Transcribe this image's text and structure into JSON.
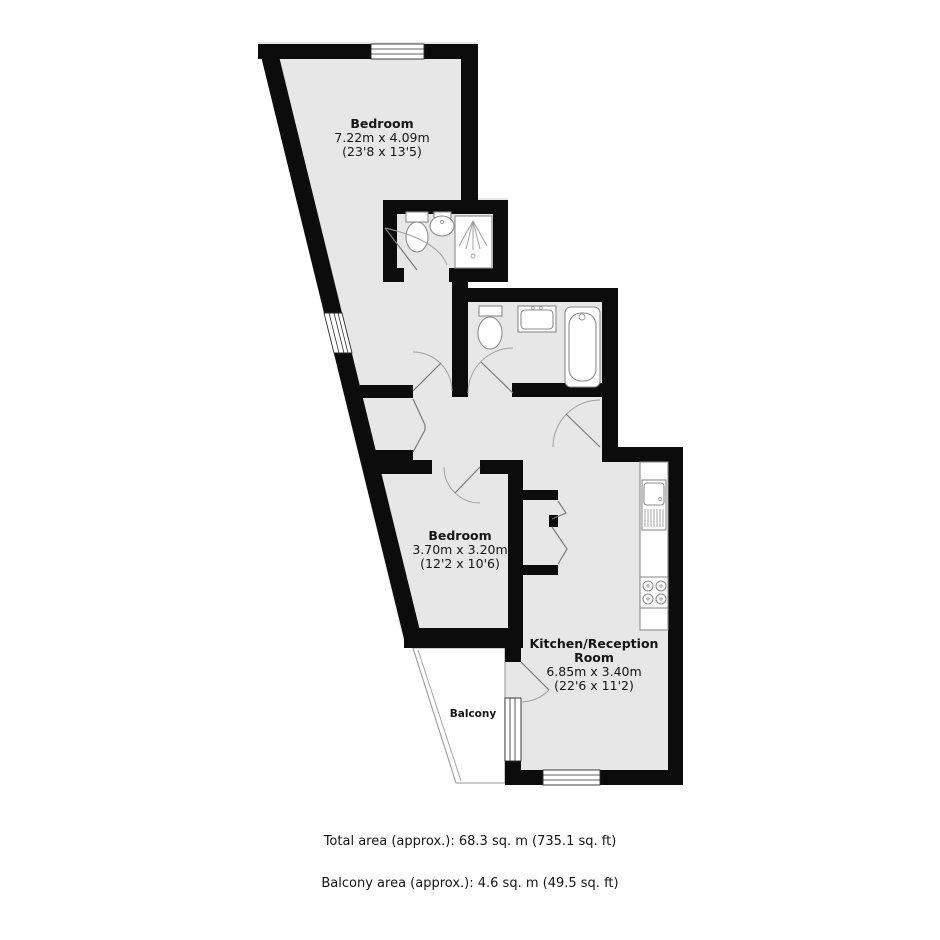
{
  "plan": {
    "rooms": {
      "bedroom1": {
        "name": "Bedroom",
        "dims_metric": "7.22m x 4.09m",
        "dims_imperial": "(23'8 x 13'5)"
      },
      "bedroom2": {
        "name": "Bedroom",
        "dims_metric": "3.70m x 3.20m",
        "dims_imperial": "(12'2 x 10'6)"
      },
      "kitchen_reception": {
        "name_line1": "Kitchen/Reception",
        "name_line2": "Room",
        "dims_metric": "6.85m x 3.40m",
        "dims_imperial": "(22'6 x 11'2)"
      },
      "balcony": {
        "name": "Balcony"
      }
    },
    "footer": {
      "total_area": "Total area (approx.): 68.3 sq. m (735.1 sq. ft)",
      "balcony_area": "Balcony area (approx.): 4.6 sq. m (49.5 sq. ft)"
    },
    "colors": {
      "wall": "#0c0c0c",
      "floor": "#e7e7e7",
      "background": "#ffffff",
      "fixture_outline": "#8c8c8c",
      "door_swing": "#a0a0a0"
    }
  }
}
